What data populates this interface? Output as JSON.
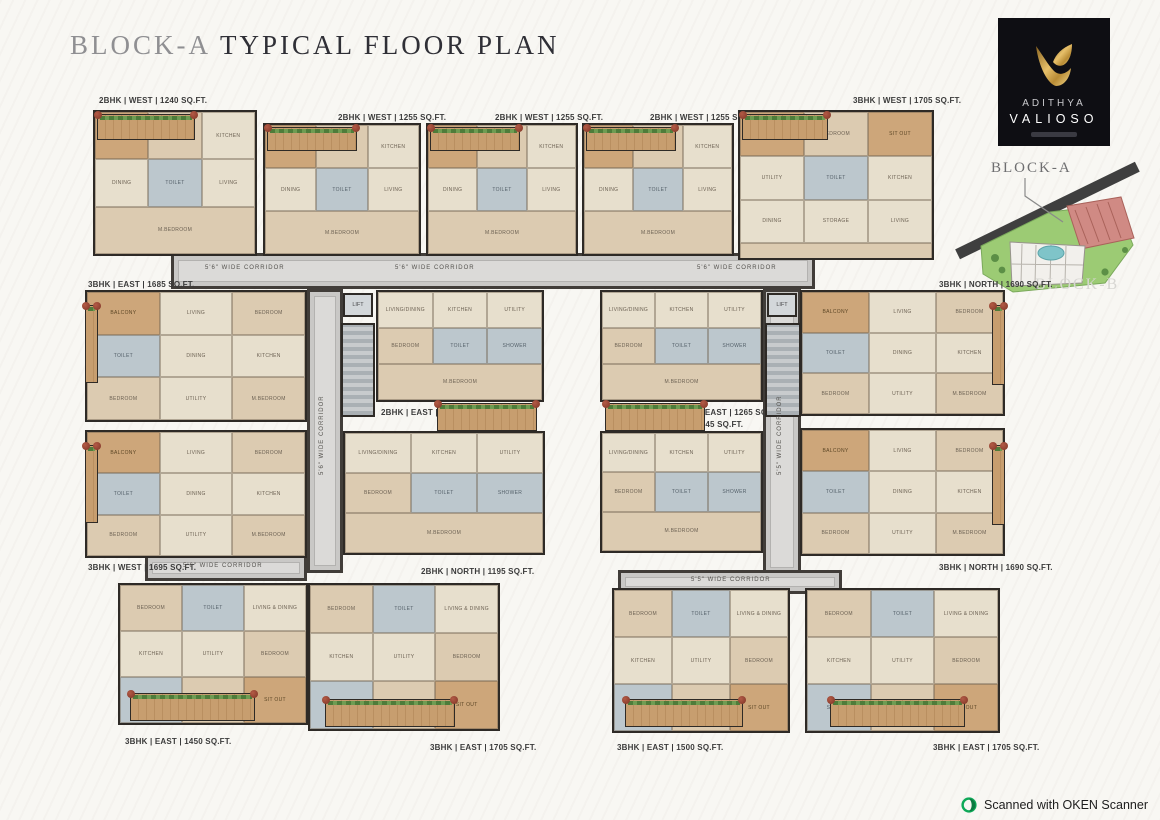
{
  "header": {
    "title_light": "BLOCK-A",
    "title_dark": "TYPICAL FLOOR PLAN"
  },
  "brand": {
    "name_top": "ADITHYA",
    "name_bottom": "VALIOSO"
  },
  "site_key": {
    "block_a": "BLOCK-A",
    "block_b": "BLOCK-B"
  },
  "watermark": {
    "text": "Scanned with OKEN Scanner"
  },
  "colors": {
    "brand_bg": "#0e0e13",
    "brand_gold": "#c9a24b",
    "wall": "#2e2a26",
    "unit_fill": "#e9e1d0",
    "wood": "#c49a6c",
    "plant_green": "#4e7c3a",
    "flower_red": "#9e4435",
    "corridor_fill": "#c9c8c6",
    "block_a_highlight": "#d08a84",
    "site_green": "#9ccb74",
    "scanner_green": "#0ea958"
  },
  "plan": {
    "room_sets": {
      "2bhk_west": [
        "BALCONY",
        "BEDROOM",
        "KITCHEN",
        "DINING",
        "TOILET",
        "LIVING",
        "M.BEDROOM"
      ],
      "3bhk_w1705": [
        "BALCONY",
        "BEDROOM",
        "SIT OUT",
        "UTILITY",
        "TOILET",
        "KITCHEN",
        "DINING",
        "STORAGE",
        "LIVING",
        "M.BEDROOM"
      ],
      "3bhk_side": [
        "BALCONY",
        "LIVING",
        "BEDROOM",
        "TOILET",
        "DINING",
        "KITCHEN",
        "BEDROOM",
        "UTILITY",
        "M.BEDROOM"
      ],
      "2bhk_center": [
        "LIVING/DINING",
        "KITCHEN",
        "UTILITY",
        "BEDROOM",
        "TOILET",
        "SHOWER",
        "M.BEDROOM"
      ],
      "3bhk_bottom": [
        "BEDROOM",
        "TOILET",
        "LIVING & DINING",
        "KITCHEN",
        "UTILITY",
        "BEDROOM",
        "SHOWER",
        "M.BEDROOM",
        "SIT OUT"
      ]
    },
    "units": [
      {
        "label": "2BHK | WEST | 1240 SQ.FT.",
        "type": "2bhk_west",
        "rect": [
          8,
          17,
          164,
          146
        ],
        "label_pos": [
          14,
          3
        ]
      },
      {
        "label": "2BHK | WEST | 1255 SQ.FT.",
        "type": "2bhk_west",
        "rect": [
          178,
          30,
          158,
          133
        ],
        "label_pos": [
          253,
          20
        ]
      },
      {
        "label": "2BHK | WEST | 1255 SQ.FT.",
        "type": "2bhk_west",
        "rect": [
          341,
          30,
          152,
          133
        ],
        "label_pos": [
          410,
          20
        ]
      },
      {
        "label": "2BHK | WEST | 1255 SQ.FT.",
        "type": "2bhk_west",
        "rect": [
          497,
          30,
          152,
          133
        ],
        "label_pos": [
          565,
          20
        ]
      },
      {
        "label": "3BHK | WEST | 1705 SQ.FT.",
        "type": "3bhk_w1705",
        "rect": [
          653,
          17,
          196,
          150
        ],
        "label_pos": [
          768,
          3
        ]
      },
      {
        "label": "3BHK | EAST | 1685 SQ.FT.",
        "type": "3bhk_side",
        "rect": [
          0,
          197,
          222,
          132
        ],
        "label_pos": [
          3,
          187
        ]
      },
      {
        "label": "3BHK | WEST | 1695 SQ.FT.",
        "type": "3bhk_side",
        "rect": [
          0,
          337,
          222,
          128
        ],
        "label_pos": [
          3,
          470
        ]
      },
      {
        "label": "2BHK | EAST | 1270 SQ.FT.",
        "type": "2bhk_center",
        "rect": [
          291,
          197,
          168,
          112
        ],
        "label_pos": [
          296,
          315
        ]
      },
      {
        "label": "2BHK | EAST | 1265 SQ.FT.",
        "type": "2bhk_center",
        "rect": [
          515,
          197,
          163,
          112
        ],
        "label_pos": [
          590,
          315
        ]
      },
      {
        "label": "2BHK | WEST | 1245 SQ.FT.",
        "type": "2bhk_center",
        "rect": [
          515,
          338,
          163,
          122
        ],
        "label_pos": [
          550,
          327
        ]
      },
      {
        "label": "2BHK | NORTH | 1195 SQ.FT.",
        "type": "2bhk_center",
        "rect": [
          258,
          338,
          202,
          124
        ],
        "label_pos": [
          336,
          474
        ]
      },
      {
        "label": "3BHK | NORTH | 1690 SQ.FT.",
        "type": "3bhk_side",
        "rect": [
          715,
          197,
          205,
          126
        ],
        "label_pos": [
          854,
          187
        ]
      },
      {
        "label": "3BHK | NORTH | 1690 SQ.FT.",
        "type": "3bhk_side",
        "rect": [
          715,
          335,
          205,
          128
        ],
        "label_pos": [
          854,
          470
        ]
      },
      {
        "label": "3BHK | EAST | 1450 SQ.FT.",
        "type": "3bhk_bottom",
        "rect": [
          33,
          490,
          190,
          142
        ],
        "label_pos": [
          40,
          644
        ]
      },
      {
        "label": "3BHK | EAST | 1705 SQ.FT.",
        "type": "3bhk_bottom",
        "rect": [
          223,
          490,
          192,
          148
        ],
        "label_pos": [
          345,
          650
        ]
      },
      {
        "label": "3BHK | EAST | 1500 SQ.FT.",
        "type": "3bhk_bottom",
        "rect": [
          527,
          495,
          178,
          145
        ],
        "label_pos": [
          532,
          650
        ]
      },
      {
        "label": "3BHK | EAST | 1705 SQ.FT.",
        "type": "3bhk_bottom",
        "rect": [
          720,
          495,
          195,
          145
        ],
        "label_pos": [
          848,
          650
        ]
      }
    ],
    "corridors": [
      {
        "rect": [
          86,
          160,
          644,
          36
        ]
      },
      {
        "rect": [
          222,
          196,
          36,
          284
        ]
      },
      {
        "rect": [
          678,
          196,
          38,
          286
        ]
      },
      {
        "rect": [
          60,
          462,
          162,
          26
        ]
      },
      {
        "rect": [
          533,
          477,
          224,
          24
        ]
      }
    ],
    "corridor_labels": [
      {
        "text": "5'6\" WIDE CORRIDOR",
        "pos": [
          120,
          172
        ],
        "vert": false
      },
      {
        "text": "5'6\" WIDE CORRIDOR",
        "pos": [
          310,
          172
        ],
        "vert": false
      },
      {
        "text": "5'6\" WIDE CORRIDOR",
        "pos": [
          612,
          172
        ],
        "vert": false
      },
      {
        "text": "5'6\" WIDE CORRIDOR",
        "pos": [
          234,
          382
        ],
        "vert": true
      },
      {
        "text": "5'5\" WIDE CORRIDOR",
        "pos": [
          692,
          382
        ],
        "vert": true
      },
      {
        "text": "5'6\" WIDE CORRIDOR",
        "pos": [
          98,
          470
        ],
        "vert": false
      },
      {
        "text": "5'5\" WIDE CORRIDOR",
        "pos": [
          606,
          484
        ],
        "vert": false
      }
    ],
    "lifts": [
      {
        "label": "LIFT",
        "rect": [
          258,
          200,
          30,
          24
        ]
      },
      {
        "label": "LIFT",
        "rect": [
          682,
          200,
          30,
          24
        ]
      }
    ],
    "stairs": [
      {
        "rect": [
          256,
          230,
          34,
          94
        ]
      },
      {
        "rect": [
          680,
          230,
          36,
          94
        ]
      }
    ],
    "balconies": [
      {
        "rect": [
          12,
          21,
          98,
          26
        ]
      },
      {
        "rect": [
          182,
          34,
          90,
          24
        ]
      },
      {
        "rect": [
          345,
          34,
          90,
          24
        ]
      },
      {
        "rect": [
          501,
          34,
          90,
          24
        ]
      },
      {
        "rect": [
          657,
          21,
          86,
          26
        ]
      },
      {
        "rect": [
          0,
          212,
          13,
          78
        ]
      },
      {
        "rect": [
          0,
          352,
          13,
          78
        ]
      },
      {
        "rect": [
          907,
          212,
          13,
          80
        ]
      },
      {
        "rect": [
          907,
          352,
          13,
          80
        ]
      },
      {
        "rect": [
          352,
          310,
          100,
          28
        ]
      },
      {
        "rect": [
          520,
          310,
          100,
          28
        ]
      },
      {
        "rect": [
          45,
          600,
          125,
          28
        ]
      },
      {
        "rect": [
          240,
          606,
          130,
          28
        ]
      },
      {
        "rect": [
          540,
          606,
          118,
          28
        ]
      },
      {
        "rect": [
          745,
          606,
          135,
          28
        ]
      }
    ]
  }
}
